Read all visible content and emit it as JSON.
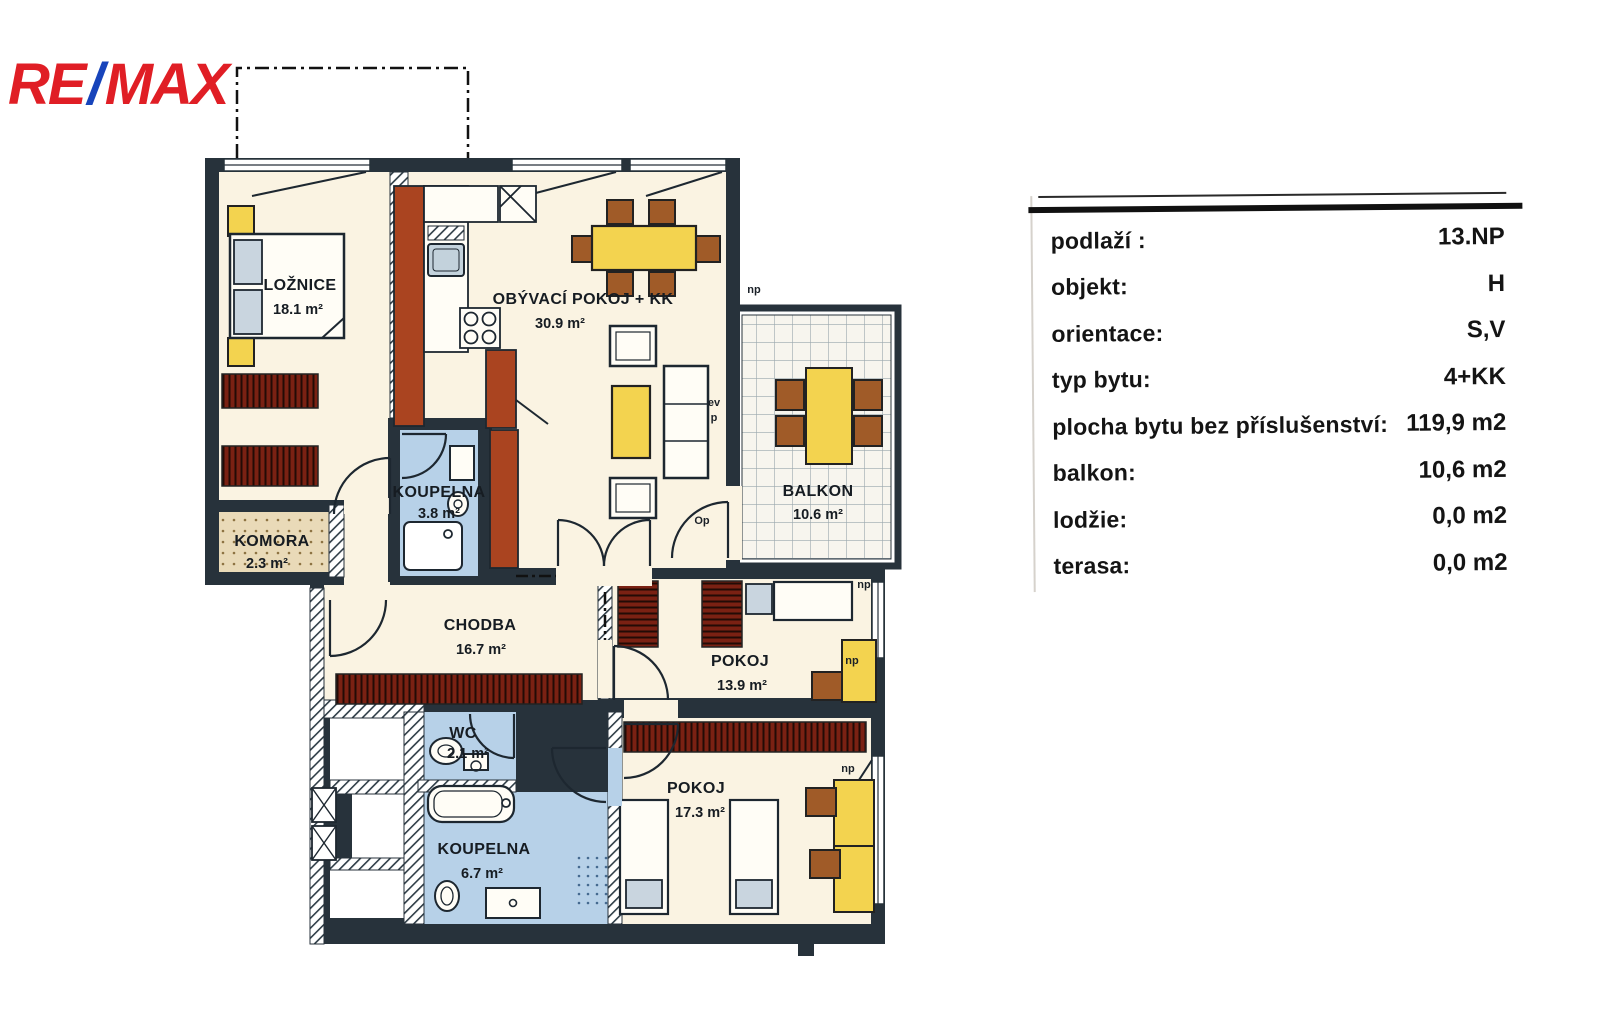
{
  "logo": {
    "re": "RE",
    "slash": "/",
    "max": "MAX"
  },
  "info_table": {
    "rows": [
      {
        "label": "podlaží :",
        "value": "13.NP"
      },
      {
        "label": "objekt:",
        "value": "H"
      },
      {
        "label": "orientace:",
        "value": "S,V"
      },
      {
        "label": "typ bytu:",
        "value": "4+KK"
      },
      {
        "label": "plocha bytu bez příslušenství:",
        "value": "119,9 m2"
      },
      {
        "label": "balkon:",
        "value": "10,6 m2"
      },
      {
        "label": "lodžie:",
        "value": "0,0 m2"
      },
      {
        "label": "terasa:",
        "value": "0,0 m2"
      }
    ]
  },
  "floor_plan": {
    "rooms": [
      {
        "id": "loznice",
        "name": "LOŽNICE",
        "area": "18.1 m²"
      },
      {
        "id": "obyvaci",
        "name": "OBÝVACÍ POKOJ + KK",
        "area": "30.9 m²"
      },
      {
        "id": "koupelna_small",
        "name": "KOUPELNA",
        "area": "3.8 m²"
      },
      {
        "id": "komora",
        "name": "KOMORA",
        "area": "2.3 m²"
      },
      {
        "id": "chodba",
        "name": "CHODBA",
        "area": "16.7 m²"
      },
      {
        "id": "balkon",
        "name": "BALKON",
        "area": "10.6 m²"
      },
      {
        "id": "pokoj_1",
        "name": "POKOJ",
        "area": "13.9 m²"
      },
      {
        "id": "wc",
        "name": "WC",
        "area": "2.1 m²"
      },
      {
        "id": "pokoj_2",
        "name": "POKOJ",
        "area": "17.3 m²"
      },
      {
        "id": "koupelna_big",
        "name": "KOUPELNA",
        "area": "6.7 m²"
      }
    ],
    "annotations": {
      "np": "np",
      "op": "Op",
      "ev": "ev",
      "p": "p"
    }
  },
  "colors": {
    "remax_red": "#e01e25",
    "remax_blue": "#1744bb",
    "wall": "#27323b",
    "room_floor": "#faf3e2",
    "bathroom_blue": "#b7d1e8",
    "wardrobe_red": "#7a2113",
    "cabinet_rust": "#aa4420",
    "furniture_yellow": "#f3d34f",
    "chair_brown": "#a05b28",
    "komora_floor": "#e9dab8"
  }
}
